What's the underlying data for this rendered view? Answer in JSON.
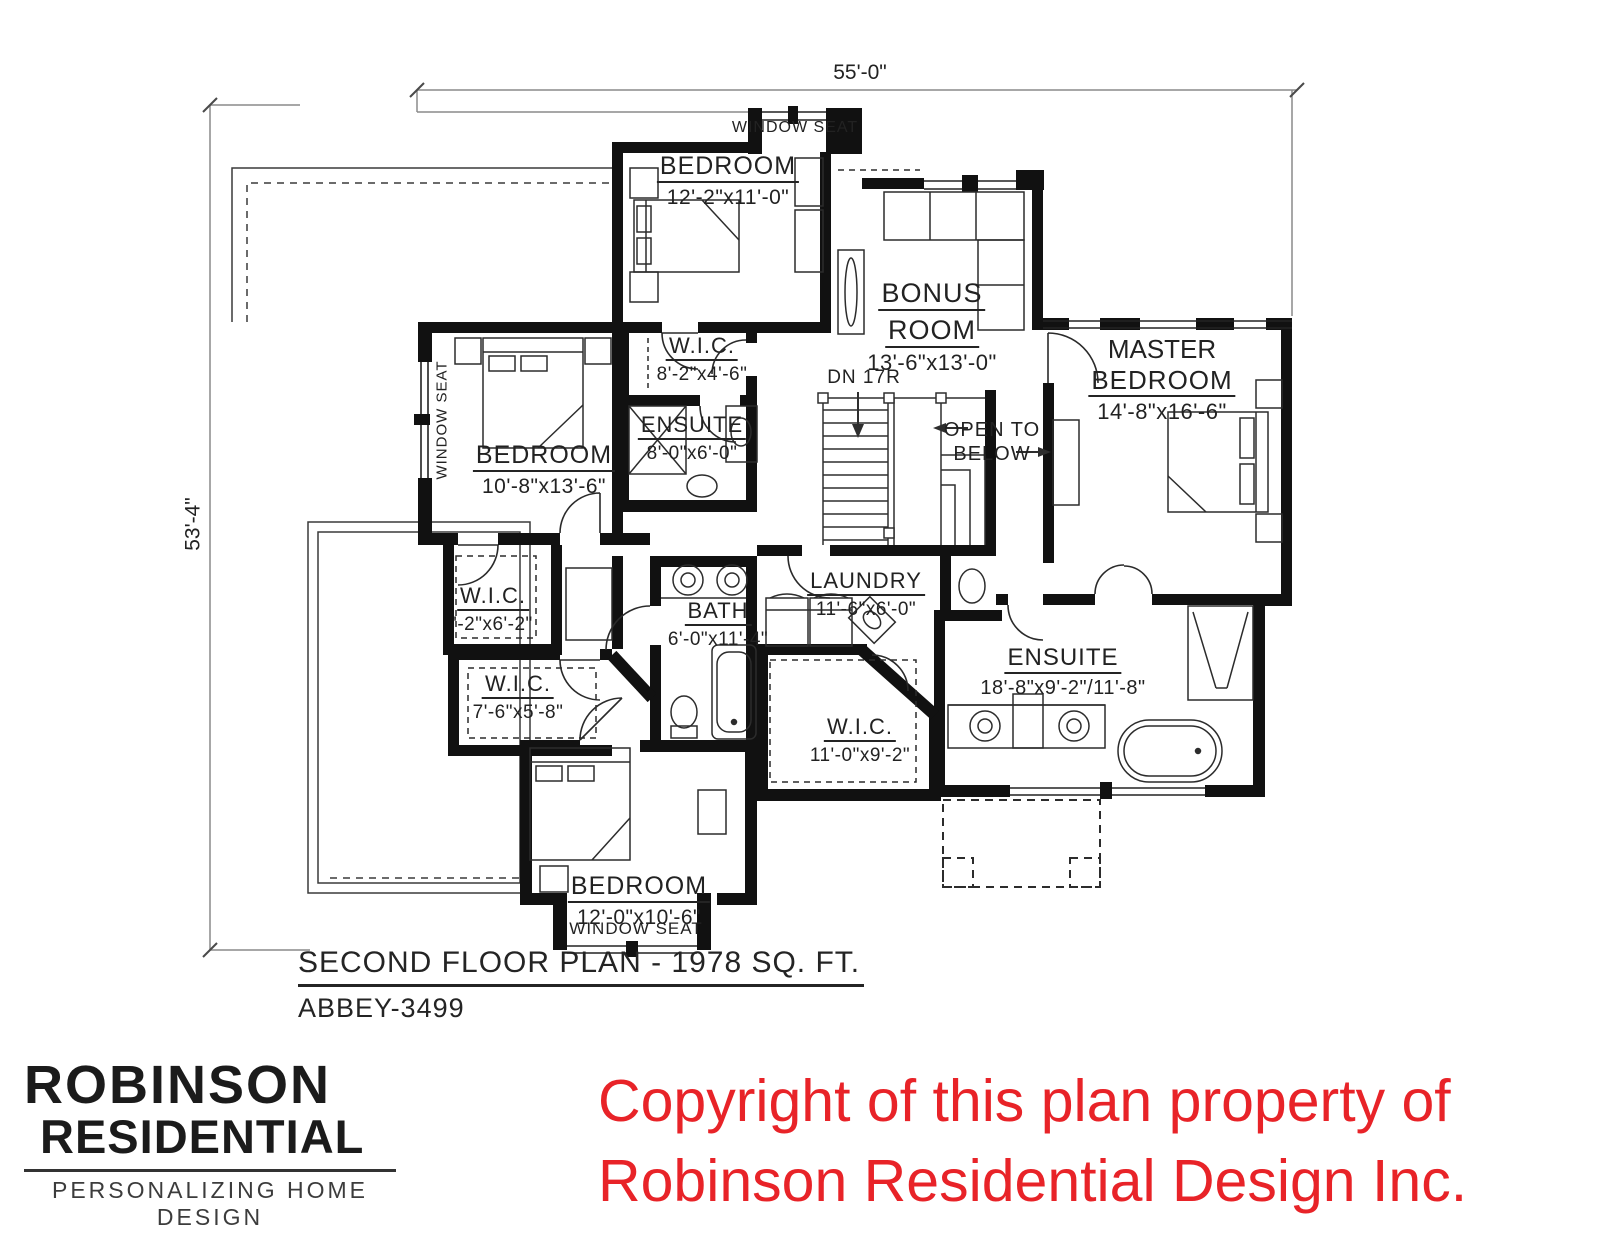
{
  "dimensions": {
    "width": "55'-0\"",
    "height": "53'-4\""
  },
  "plan": {
    "title": "SECOND FLOOR PLAN - 1978 SQ. FT.",
    "plan_number": "ABBEY-3499",
    "stairs_note": "DN 17R",
    "open_to_below_line1": "OPEN TO",
    "open_to_below_line2": "BELOW",
    "window_seat_top": "WINDOW SEAT",
    "window_seat_left": "WINDOW SEAT",
    "window_seat_bottom": "WINDOW SEAT",
    "rooms": [
      {
        "id": "bedroom-top",
        "name": "BEDROOM",
        "dims": "12'-2\"x11'-0\""
      },
      {
        "id": "bonus-room",
        "name_line1": "BONUS",
        "name_line2": "ROOM",
        "dims": "13'-6\"x13'-0\""
      },
      {
        "id": "master-bedroom",
        "name_line1": "MASTER",
        "name_line2": "BEDROOM",
        "dims": "14'-8\"x16'-6\""
      },
      {
        "id": "wic-upper",
        "name": "W.I.C.",
        "dims": "8'-2\"x4'-6\""
      },
      {
        "id": "ensuite-small",
        "name": "ENSUITE",
        "dims": "8'-0\"x6'-0\""
      },
      {
        "id": "bedroom-left",
        "name": "BEDROOM",
        "dims": "10'-8\"x13'-6\""
      },
      {
        "id": "wic-left",
        "name": "W.I.C.",
        "dims": "'-2\"x6'-2\""
      },
      {
        "id": "wic-lower-left",
        "name": "W.I.C.",
        "dims": "7'-6\"x5'-8\""
      },
      {
        "id": "bath",
        "name": "BATH",
        "dims": "6'-0\"x11'-4\""
      },
      {
        "id": "laundry",
        "name": "LAUNDRY",
        "dims": "11'-6\"x6'-0\""
      },
      {
        "id": "ensuite-master",
        "name": "ENSUITE",
        "dims": "18'-8\"x9'-2\"/11'-8\""
      },
      {
        "id": "wic-master",
        "name": "W.I.C.",
        "dims": "11'-0\"x9'-2\""
      },
      {
        "id": "bedroom-bottom",
        "name": "BEDROOM",
        "dims": "12'-0\"x10'-6\""
      }
    ]
  },
  "branding": {
    "line1": "ROBINSON",
    "line2": "RESIDENTIAL",
    "tagline": "PERSONALIZING HOME DESIGN"
  },
  "copyright": {
    "line1": "Copyright of this plan property of",
    "line2": "Robinson Residential Design Inc.",
    "color": "#e82328"
  }
}
